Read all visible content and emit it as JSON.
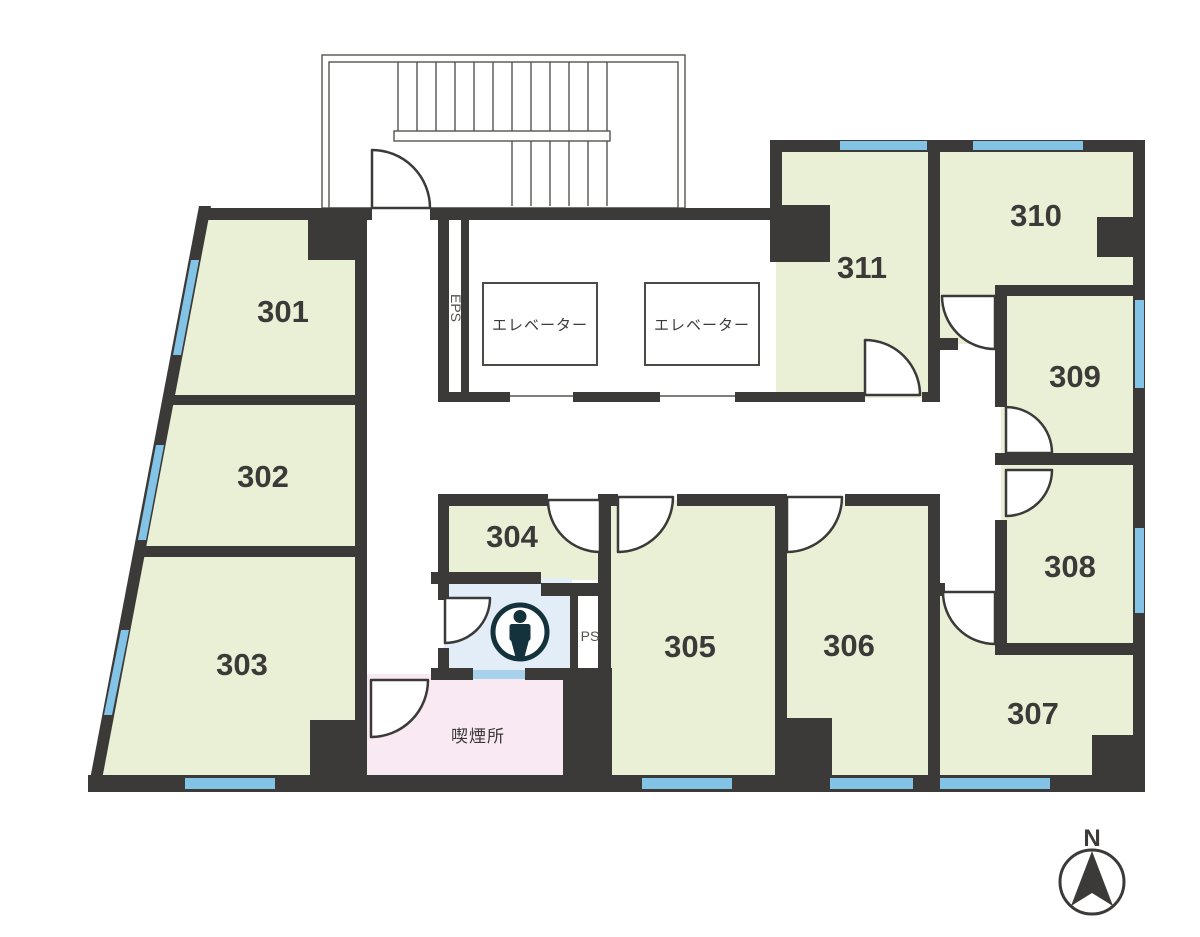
{
  "diagram_type": "floor-plan",
  "floor": "3F",
  "rooms": {
    "r301": {
      "label": "301"
    },
    "r302": {
      "label": "302"
    },
    "r303": {
      "label": "303"
    },
    "r304": {
      "label": "304"
    },
    "r305": {
      "label": "305"
    },
    "r306": {
      "label": "306"
    },
    "r307": {
      "label": "307"
    },
    "r308": {
      "label": "308"
    },
    "r309": {
      "label": "309"
    },
    "r310": {
      "label": "310"
    },
    "r311": {
      "label": "311"
    }
  },
  "facilities": {
    "elevator_1": "エレベーター",
    "elevator_2": "エレベーター",
    "eps": "EPS",
    "ps": "PS",
    "smoking_area": "喫煙所",
    "restroom_icon": "person-icon",
    "stairs": "stairwell"
  },
  "compass": {
    "north_label": "N"
  },
  "colors": {
    "wall": "#3b3a38",
    "room_fill": "#eaf0d6",
    "window": "#83c3e6",
    "restroom_fill": "#e3edf7",
    "restroom_window": "#a8d2ec",
    "smoking_fill": "#f8e9f2",
    "icon_teal": "#13323c",
    "background": "#ffffff"
  }
}
